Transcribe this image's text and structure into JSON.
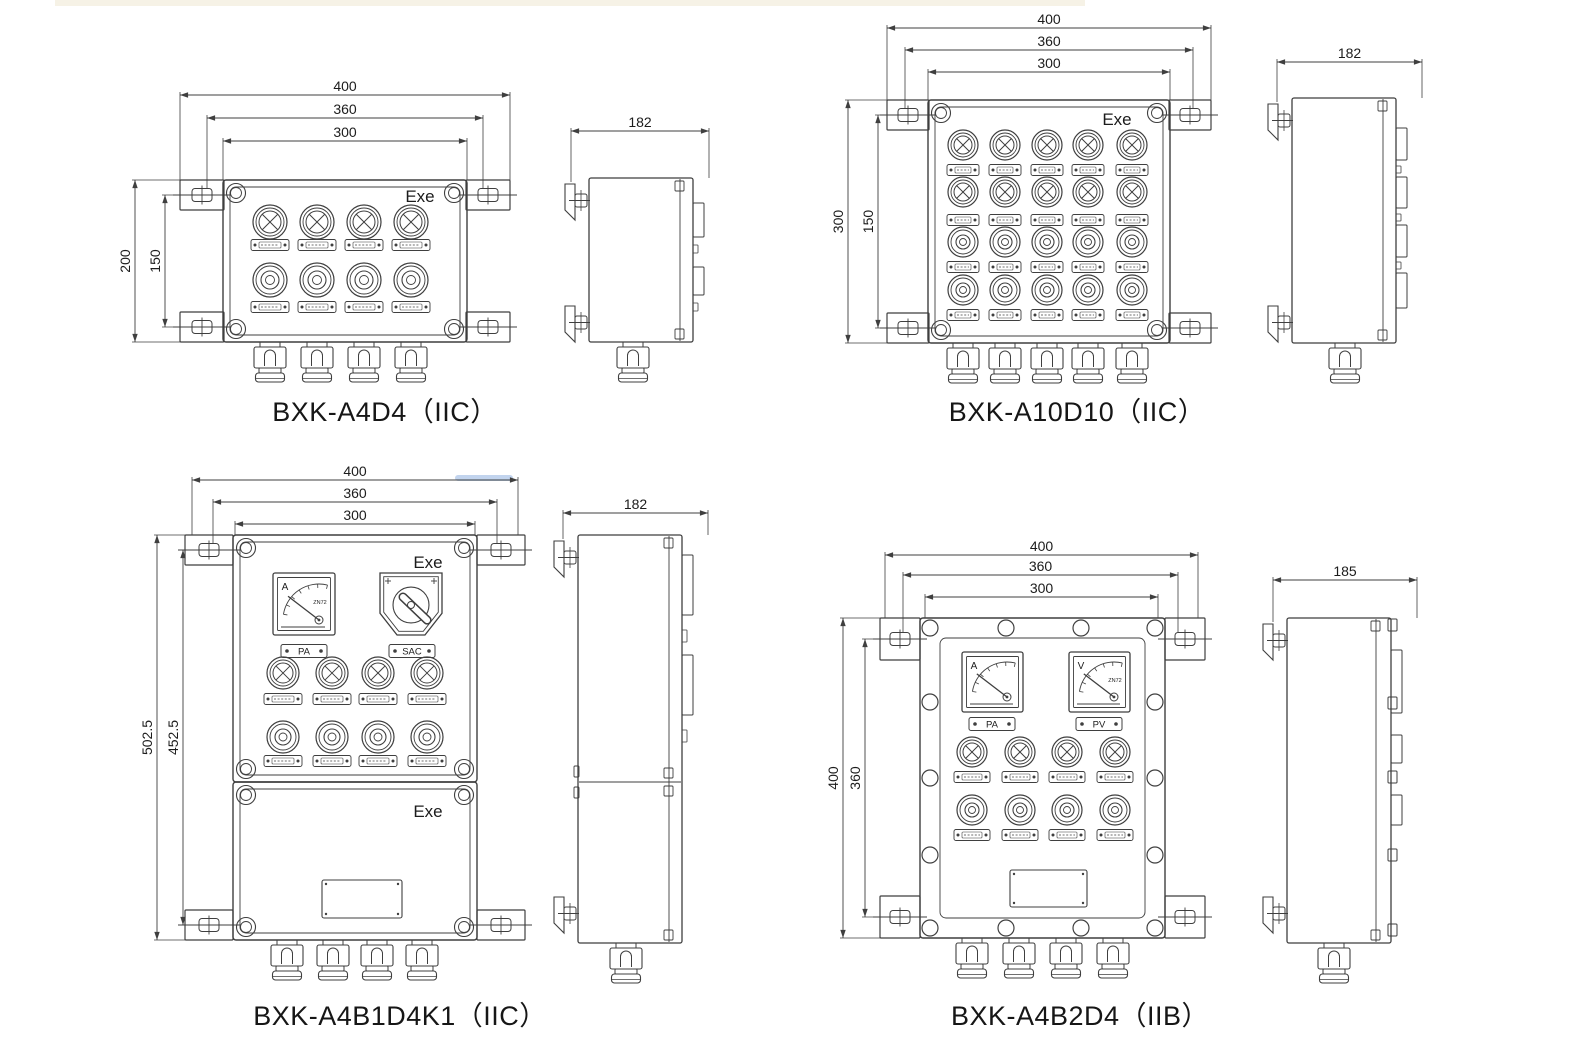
{
  "page": {
    "background": "#ffffff",
    "line_color": "#3f3f3f",
    "text_color": "#1c1c1c"
  },
  "drawings": [
    {
      "caption": "BXK-A4D4（IIC）",
      "marking": "Exe",
      "front": {
        "top_dims": [
          "400",
          "360",
          "300"
        ],
        "left_dims": [
          "200",
          "150"
        ],
        "columns": 4,
        "control_rows": [
          "indicator-lamps",
          "push-buttons"
        ],
        "cable_glands": 4
      },
      "side": {
        "dim": "182"
      }
    },
    {
      "caption": "BXK-A10D10（IIC）",
      "marking": "Exe",
      "front": {
        "top_dims": [
          "400",
          "360",
          "300"
        ],
        "left_dims": [
          "300",
          "150"
        ],
        "columns": 5,
        "control_rows": [
          "indicator-lamps",
          "indicator-lamps",
          "push-buttons",
          "push-buttons"
        ],
        "cable_glands": 5
      },
      "side": {
        "dim": "182"
      }
    },
    {
      "caption": "BXK-A4B1D4K1（IIC）",
      "marking": "Exe",
      "lower_marking": "Exe",
      "front": {
        "top_dims": [
          "400",
          "360",
          "300"
        ],
        "left_dims": [
          "502.5",
          "452.5"
        ],
        "columns": 4,
        "control_rows": [
          "indicator-lamps",
          "push-buttons"
        ],
        "meters": [
          {
            "letter": "A",
            "model": "ZN72",
            "plate": "PA"
          }
        ],
        "switch": {
          "plate": "SAC"
        },
        "cable_glands": 4
      },
      "side": {
        "dim": "182"
      }
    },
    {
      "caption": "BXK-A4B2D4（IIB）",
      "front": {
        "top_dims": [
          "400",
          "360",
          "300"
        ],
        "left_dims": [
          "400",
          "360"
        ],
        "columns": 4,
        "control_rows": [
          "indicator-lamps",
          "push-buttons"
        ],
        "meters": [
          {
            "letter": "A",
            "model": "",
            "plate": "PA"
          },
          {
            "letter": "V",
            "model": "ZN72",
            "plate": "PV"
          }
        ],
        "cable_glands": 4
      },
      "side": {
        "dim": "185"
      }
    }
  ]
}
